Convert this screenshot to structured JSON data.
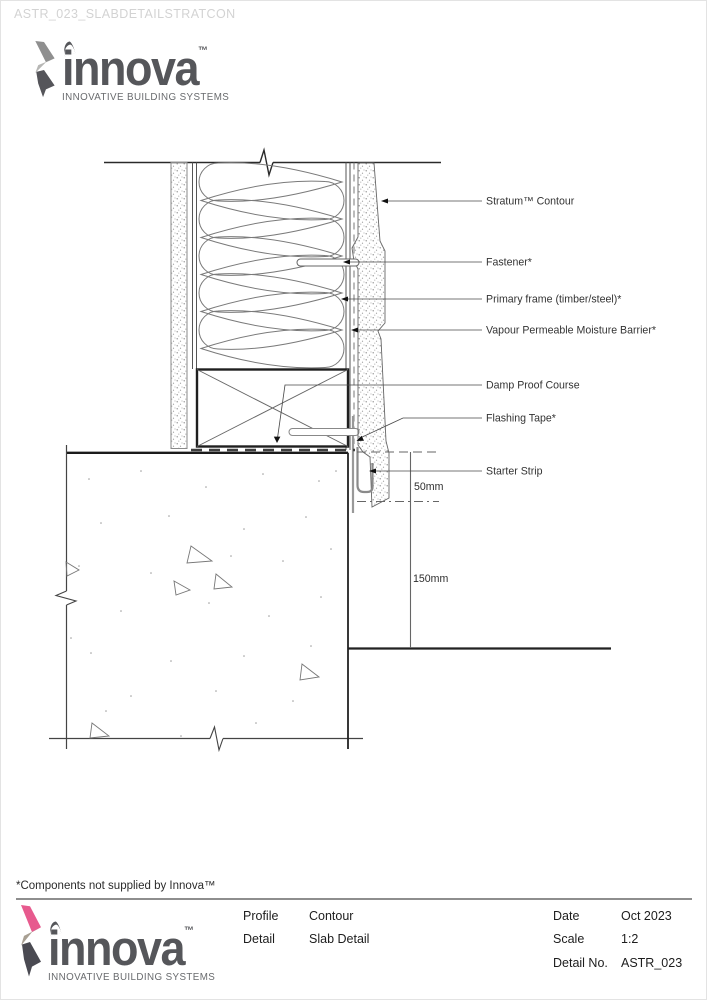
{
  "watermark": "ASTR_023_SLABDETAILSTRATCON",
  "logo": {
    "name": "innova",
    "tm": "™",
    "tagline": "INNOVATIVE BUILDING SYSTEMS"
  },
  "colors": {
    "brand_pink": "#e75a8e",
    "mark_warm_gray": "#a89f92",
    "mark_charcoal": "#4a4a52",
    "mark_gray_top": "#8f8f8f",
    "mark_gray_mid": "#b7b7b5",
    "mark_gray_dark": "#55555a",
    "logo_text": "#55565a"
  },
  "drawing": {
    "labels": {
      "stratum": "Stratum™ Contour",
      "fastener": "Fastener*",
      "primary_frame": "Primary frame (timber/steel)*",
      "vapour_barrier": "Vapour Permeable Moisture Barrier*",
      "dpc": "Damp Proof Course",
      "flashing_tape": "Flashing Tape*",
      "starter_strip": "Starter Strip"
    },
    "dimensions": {
      "gap": "50mm",
      "depth": "150mm"
    }
  },
  "footnote": "*Components not supplied by Innova™",
  "titleblock": {
    "left": [
      {
        "label": "Profile",
        "value": "Contour"
      },
      {
        "label": "Detail",
        "value": "Slab Detail"
      }
    ],
    "right": [
      {
        "label": "Date",
        "value": "Oct 2023"
      },
      {
        "label": "Scale",
        "value": "1:2"
      },
      {
        "label": "Detail No.",
        "value": "ASTR_023"
      }
    ]
  }
}
